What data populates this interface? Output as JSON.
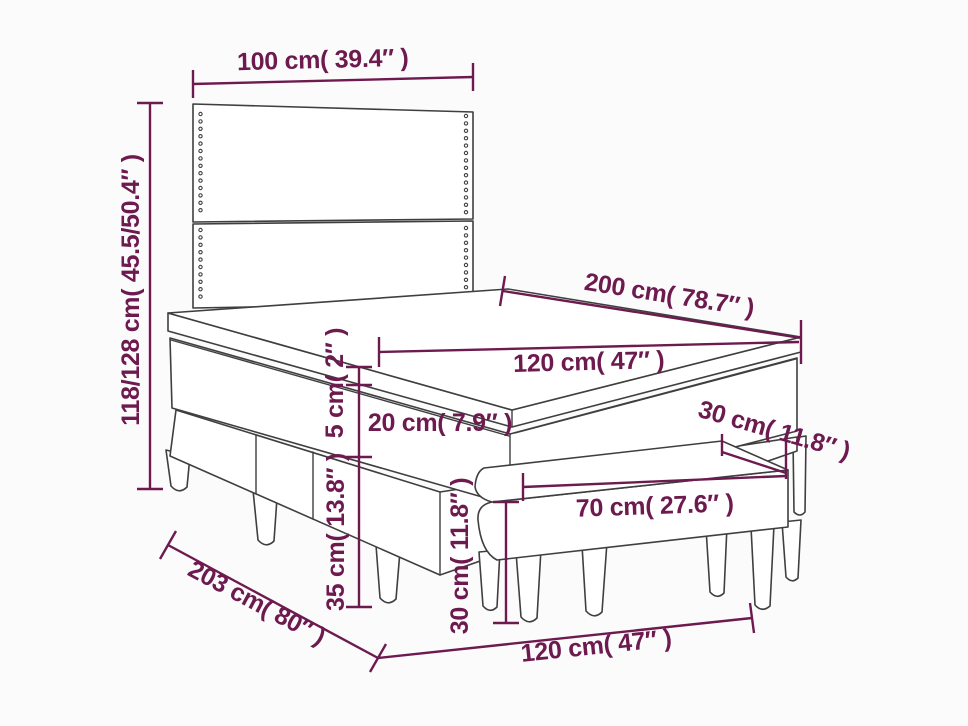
{
  "diagram": {
    "type": "product-dimension-diagram",
    "subject": "box spring bed with headboard, mattress topper and bench",
    "colors": {
      "background": "#fcfbfc",
      "furniture_line": "#3f3f3f",
      "dimension": "#6d1a4f"
    },
    "dimensions": {
      "headboard_width": "100 cm( 39.4″ )",
      "total_height": "118/128 cm( 45.5/50.4″ )",
      "bed_length": "200 cm( 78.7″ )",
      "mattress_width": "120 cm( 47″ )",
      "topper_thickness": "5 cm( 2″ )",
      "mattress_thickness": "20 cm( 7.9″ )",
      "base_height": "35 cm( 13.8″ )",
      "bench_height": "30 cm( 11.8″ )",
      "bench_width": "70 cm( 27.6″ )",
      "bench_depth": "30 cm( 11.8″ )",
      "floor_length": "203 cm( 80″ )",
      "floor_width": "120 cm( 47″ )"
    }
  }
}
